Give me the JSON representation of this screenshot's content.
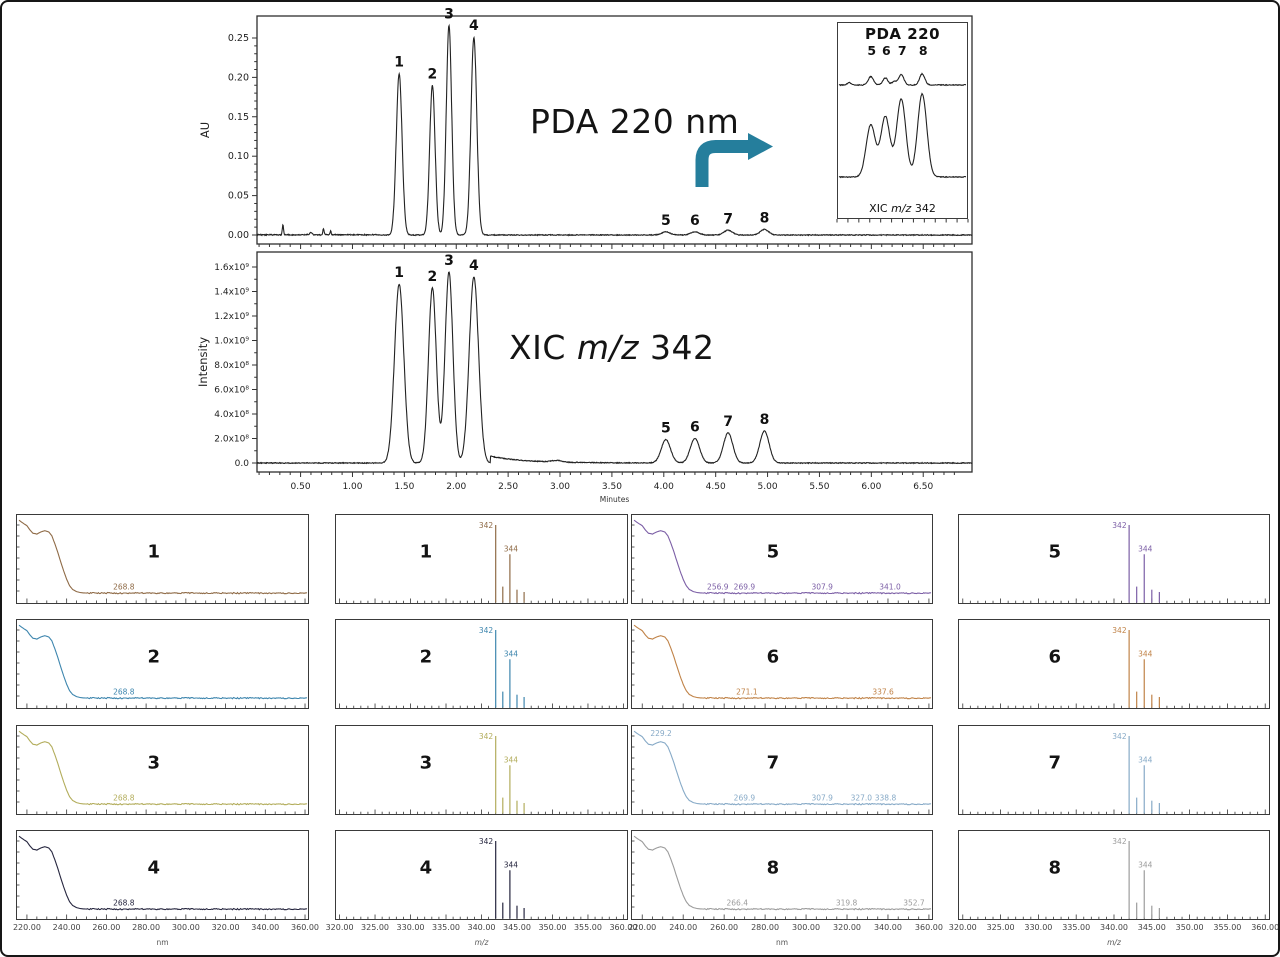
{
  "ui": {
    "pda_title": "PDA 220 nm",
    "xic_title_prefix": "XIC",
    "xic_title_italic": "m/z",
    "xic_title_suffix": "342",
    "inset_title": "PDA 220",
    "inset_caption_prefix": "XIC",
    "inset_caption_italic": "m/z",
    "inset_caption_suffix": "342",
    "arrow_color": "#257e9c",
    "trace_color": "#222222",
    "frame_color": "#2e2e2e"
  },
  "chart_data": [
    {
      "id": "pda",
      "type": "line",
      "title": "PDA 220 nm",
      "ylabel": "AU",
      "xlim": [
        0.08,
        6.97
      ],
      "ylim": [
        0,
        0.25
      ],
      "yticks": [
        "0.00",
        "0.05",
        "0.10",
        "0.15",
        "0.20",
        "0.25"
      ],
      "grid": false,
      "peaks": [
        {
          "label": "1",
          "rt": 1.45,
          "height": 0.205,
          "sigma": 0.028
        },
        {
          "label": "2",
          "rt": 1.77,
          "height": 0.19,
          "sigma": 0.026
        },
        {
          "label": "3",
          "rt": 1.93,
          "height": 0.266,
          "sigma": 0.026
        },
        {
          "label": "4",
          "rt": 2.17,
          "height": 0.251,
          "sigma": 0.028
        },
        {
          "label": "5",
          "rt": 4.02,
          "height": 0.004,
          "sigma": 0.04
        },
        {
          "label": "6",
          "rt": 4.3,
          "height": 0.004,
          "sigma": 0.04
        },
        {
          "label": "7",
          "rt": 4.62,
          "height": 0.006,
          "sigma": 0.04
        },
        {
          "label": "8",
          "rt": 4.97,
          "height": 0.007,
          "sigma": 0.04
        }
      ],
      "artifacts": [
        {
          "rt": 0.33,
          "height": 0.013,
          "sigma": 0.006
        },
        {
          "rt": 0.6,
          "height": 0.003,
          "sigma": 0.012
        },
        {
          "rt": 0.72,
          "height": 0.008,
          "sigma": 0.006
        },
        {
          "rt": 0.79,
          "height": 0.005,
          "sigma": 0.005
        }
      ]
    },
    {
      "id": "xic",
      "type": "line",
      "title": "XIC m/z 342",
      "ylabel": "Intensity",
      "xlabel": "Minutes",
      "xlim": [
        0.08,
        6.97
      ],
      "ylim": [
        0,
        1600000000.0
      ],
      "ytick_labels": [
        "0.0",
        "2.0x10⁸",
        "4.0x10⁸",
        "6.0x10⁸",
        "8.0x10⁸",
        "1.0x10⁹",
        "1.2x10⁹",
        "1.4x10⁹",
        "1.6x10⁹"
      ],
      "xticks": [
        "0.50",
        "1.00",
        "1.50",
        "2.00",
        "2.50",
        "3.00",
        "3.50",
        "4.00",
        "4.50",
        "5.00",
        "5.50",
        "6.00",
        "6.50"
      ],
      "grid": false,
      "peaks": [
        {
          "label": "1",
          "rt": 1.45,
          "height": 1460000000.0,
          "sigma": 0.045
        },
        {
          "label": "2",
          "rt": 1.77,
          "height": 1430000000.0,
          "sigma": 0.038
        },
        {
          "label": "3",
          "rt": 1.93,
          "height": 1560000000.0,
          "sigma": 0.038
        },
        {
          "label": "4",
          "rt": 2.17,
          "height": 1520000000.0,
          "sigma": 0.045
        },
        {
          "label": "5",
          "rt": 4.02,
          "height": 190000000.0,
          "sigma": 0.045
        },
        {
          "label": "6",
          "rt": 4.3,
          "height": 200000000.0,
          "sigma": 0.045
        },
        {
          "label": "7",
          "rt": 4.62,
          "height": 245000000.0,
          "sigma": 0.045
        },
        {
          "label": "8",
          "rt": 4.97,
          "height": 260000000.0,
          "sigma": 0.045
        }
      ]
    },
    {
      "id": "inset",
      "type": "line",
      "title": "PDA 220",
      "caption": "XIC m/z 342",
      "peak_labels": [
        "5",
        "6",
        "7",
        "8"
      ],
      "peak_fx": [
        0.25,
        0.365,
        0.49,
        0.655
      ],
      "pda_rel_heights": [
        0.06,
        0.05,
        0.075,
        0.08
      ],
      "xic_rel_heights": [
        0.5,
        0.58,
        0.75,
        0.8
      ]
    },
    {
      "id": "uv_spectra",
      "type": "line",
      "xlabel": "nm",
      "xlim": [
        215,
        361.5
      ],
      "xtick_values": [
        220,
        240,
        260,
        280,
        300,
        320,
        340,
        360
      ],
      "xticks": [
        "220.00",
        "240.00",
        "260.00",
        "280.00",
        "300.00",
        "320.00",
        "340.00",
        "360.00"
      ],
      "panels": [
        {
          "peak": "1",
          "color": "#8f6b47",
          "annotations": [
            {
              "wl": 268.8,
              "label": "268.8"
            }
          ]
        },
        {
          "peak": "2",
          "color": "#3e86ae",
          "annotations": [
            {
              "wl": 268.8,
              "label": "268.8"
            }
          ]
        },
        {
          "peak": "3",
          "color": "#b3ad5c",
          "annotations": [
            {
              "wl": 268.8,
              "label": "268.8"
            }
          ]
        },
        {
          "peak": "4",
          "color": "#26263f",
          "annotations": [
            {
              "wl": 268.8,
              "label": "268.8"
            }
          ]
        },
        {
          "peak": "5",
          "color": "#7c5fa6",
          "annotations": [
            {
              "wl": 256.9,
              "label": "256.9"
            },
            {
              "wl": 269.9,
              "label": "269.9"
            },
            {
              "wl": 307.9,
              "label": "307.9"
            },
            {
              "wl": 341.0,
              "label": "341.0"
            }
          ]
        },
        {
          "peak": "6",
          "color": "#c08348",
          "annotations": [
            {
              "wl": 271.1,
              "label": "271.1"
            },
            {
              "wl": 337.6,
              "label": "337.6"
            }
          ]
        },
        {
          "peak": "7",
          "color": "#87aac7",
          "annotations": [
            {
              "wl": 229.2,
              "label": "229.2",
              "top": true
            },
            {
              "wl": 269.9,
              "label": "269.9"
            },
            {
              "wl": 307.9,
              "label": "307.9"
            },
            {
              "wl": 327.0,
              "label": "327.0"
            },
            {
              "wl": 338.8,
              "label": "338.8"
            }
          ]
        },
        {
          "peak": "8",
          "color": "#9c9c9c",
          "annotations": [
            {
              "wl": 266.4,
              "label": "266.4"
            },
            {
              "wl": 319.8,
              "label": "319.8"
            },
            {
              "wl": 352.7,
              "label": "352.7"
            }
          ]
        }
      ]
    },
    {
      "id": "ms_spectra",
      "type": "stick",
      "xlabel": "m/z",
      "xlabel_italic": true,
      "xlim": [
        319.5,
        360.5
      ],
      "xtick_values": [
        320,
        325,
        330,
        335,
        340,
        345,
        350,
        355,
        360
      ],
      "xticks": [
        "320.00",
        "325.00",
        "330.00",
        "335.00",
        "340.00",
        "345.00",
        "350.00",
        "355.00",
        "360.00"
      ],
      "sticks": [
        {
          "mz": 342,
          "rel": 1.0,
          "label": "342"
        },
        {
          "mz": 343,
          "rel": 0.2
        },
        {
          "mz": 344,
          "rel": 0.62,
          "label": "344"
        },
        {
          "mz": 345,
          "rel": 0.16
        },
        {
          "mz": 346,
          "rel": 0.13
        }
      ],
      "panels": [
        {
          "peak": "1",
          "color": "#8f6b47"
        },
        {
          "peak": "2",
          "color": "#3e86ae"
        },
        {
          "peak": "3",
          "color": "#b3ad5c"
        },
        {
          "peak": "4",
          "color": "#26263f"
        },
        {
          "peak": "5",
          "color": "#7c5fa6"
        },
        {
          "peak": "6",
          "color": "#c08348"
        },
        {
          "peak": "7",
          "color": "#87aac7"
        },
        {
          "peak": "8",
          "color": "#9c9c9c"
        }
      ]
    }
  ]
}
